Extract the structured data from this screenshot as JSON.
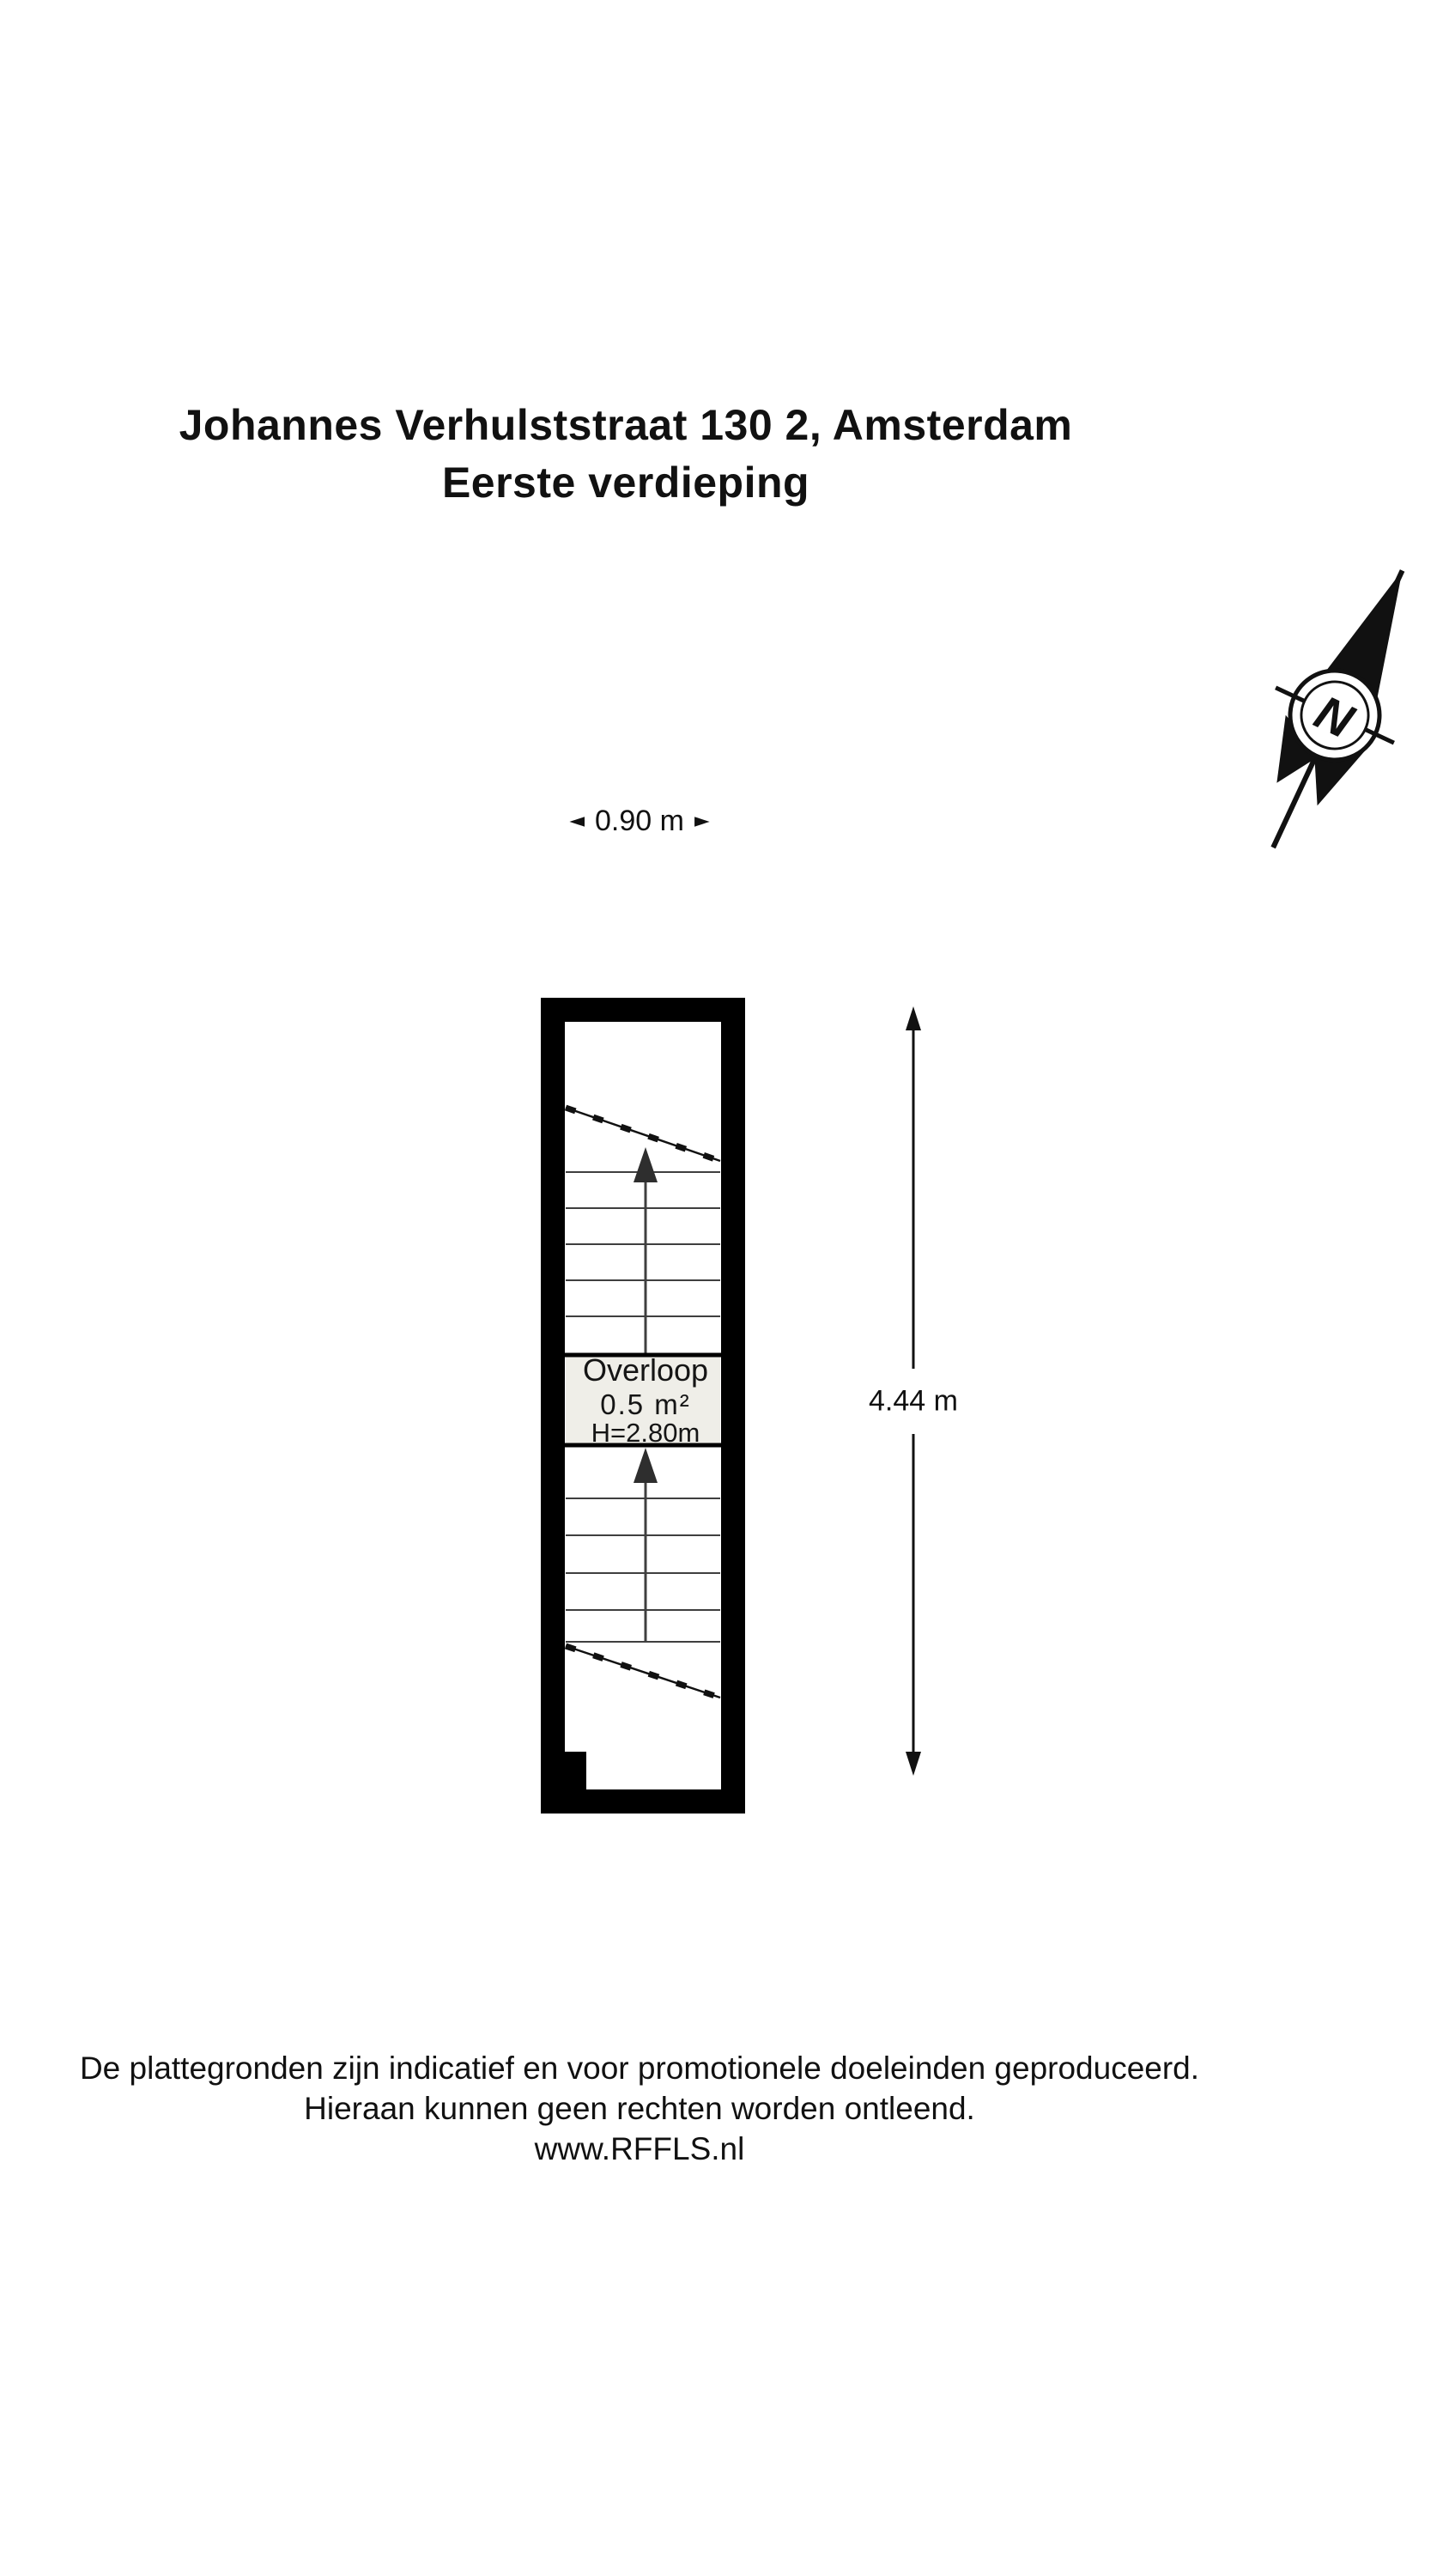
{
  "title": {
    "line1": "Johannes Verhulststraat 130 2, Amsterdam",
    "line2": "Eerste verdieping"
  },
  "compass": {
    "letter": "N"
  },
  "dimensions": {
    "width": {
      "label": "0.90 m",
      "arrow_left": "◄",
      "arrow_right": "►"
    },
    "height": {
      "label": "4.44 m"
    }
  },
  "floorplan": {
    "room": {
      "name": "Overloop",
      "area": "0.5 m²",
      "ceiling_height": "H=2.80m"
    },
    "features": [
      "staircase-up-upper-flight",
      "staircase-up-lower-flight",
      "landing"
    ],
    "colors": {
      "wall": "#000000",
      "floor": "#ffffff",
      "landing_fill": "#efeee8",
      "tread_line": "#3f3f3f",
      "ink": "#111111"
    }
  },
  "footer": {
    "line1": "De plattegronden zijn indicatief en voor promotionele doeleinden geproduceerd.",
    "line2": "Hieraan kunnen geen rechten worden ontleend.",
    "line3": "www.RFFLS.nl"
  }
}
